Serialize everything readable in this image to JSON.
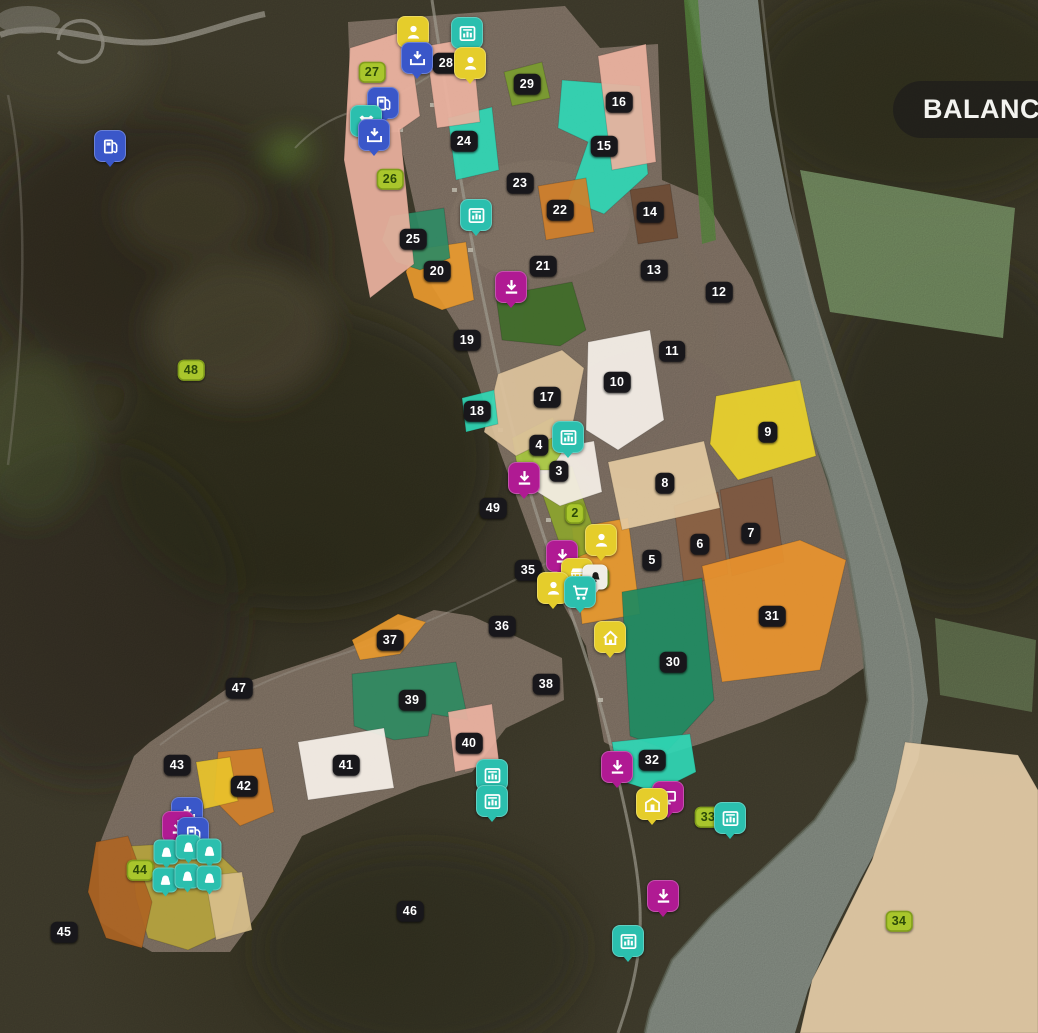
{
  "hud": {
    "balance_label": "BALANCE:"
  },
  "palette": {
    "badge": "#18171b",
    "badge_owned": "#a9c62c",
    "icon_blue": "#3a57c9",
    "icon_yellow": "#e5cd2b",
    "icon_teal": "#2bbfae",
    "icon_magenta": "#b01a93"
  },
  "map": {
    "fields": [
      {
        "num": "1",
        "bx": 600,
        "by": 578,
        "owned": true,
        "fill": "#e8992e",
        "poly": "572,528 628,518 640,614 582,624"
      },
      {
        "num": "2",
        "bx": 575,
        "by": 513,
        "owned": true,
        "fill": "#8ba32e",
        "poly": "536,476 572,466 600,548 566,562"
      },
      {
        "num": "3",
        "bx": 559,
        "by": 471,
        "fill": "#f6f0e8",
        "poly": "534,452 594,441 602,492 560,506 531,488"
      },
      {
        "num": "4",
        "bx": 539,
        "by": 445,
        "fill": "#a5c63e",
        "poly": "512,438 553,417 562,452 550,470 518,470"
      },
      {
        "num": "5",
        "bx": 652,
        "by": 560
      },
      {
        "num": "6",
        "bx": 700,
        "by": 544,
        "fill": "#8a5f42",
        "poly": "674,506 718,492 728,574 684,586"
      },
      {
        "num": "7",
        "bx": 751,
        "by": 533,
        "fill": "#7d5740",
        "poly": "720,490 772,477 784,562 732,576"
      },
      {
        "num": "8",
        "bx": 665,
        "by": 483,
        "fill": "#e3caa2",
        "poly": "608,462 704,441 720,508 622,530"
      },
      {
        "num": "9",
        "bx": 768,
        "by": 432,
        "fill": "#ead32b",
        "poly": "716,396 800,380 816,456 738,480 710,444"
      },
      {
        "num": "10",
        "bx": 617,
        "by": 382,
        "fill": "#f6f1ea",
        "poly": "588,342 650,330 664,420 618,450 586,430"
      },
      {
        "num": "11",
        "bx": 672,
        "by": 351
      },
      {
        "num": "12",
        "bx": 719,
        "by": 292
      },
      {
        "num": "13",
        "bx": 654,
        "by": 270
      },
      {
        "num": "14",
        "bx": 650,
        "by": 212,
        "fill": "#6b4a33",
        "poly": "630,190 670,184 678,238 638,244"
      },
      {
        "num": "15",
        "bx": 604,
        "by": 146,
        "fill": "#2fd7b5",
        "poly": "562,80 640,86 648,174 604,214 568,200 588,142 558,128"
      },
      {
        "num": "16",
        "bx": 619,
        "by": 102,
        "fill": "#ecb2a0",
        "poly": "598,56 646,44 656,162 612,170"
      },
      {
        "num": "17",
        "bx": 547,
        "by": 397,
        "fill": "#dcc29c",
        "poly": "498,374 562,350 584,368 572,428 516,456 484,432"
      },
      {
        "num": "18",
        "bx": 477,
        "by": 411,
        "fill": "#2fd7b5",
        "poly": "462,398 494,390 498,424 466,432"
      },
      {
        "num": "19",
        "bx": 467,
        "by": 340
      },
      {
        "num": "20",
        "bx": 437,
        "by": 271,
        "fill": "#e8992e",
        "poly": "412,250 466,242 474,300 442,310 414,298 406,272"
      },
      {
        "num": "21",
        "bx": 543,
        "by": 266,
        "fill": "#3e6b28",
        "poly": "496,296 572,282 586,330 560,346 502,340"
      },
      {
        "num": "22",
        "bx": 560,
        "by": 210,
        "fill": "#d07f2a",
        "poly": "538,186 586,178 594,232 546,240"
      },
      {
        "num": "23",
        "bx": 520,
        "by": 183
      },
      {
        "num": "24",
        "bx": 464,
        "by": 141,
        "fill": "#2fd7b5",
        "poly": "448,118 492,107 499,170 456,180"
      },
      {
        "num": "25",
        "bx": 413,
        "by": 239,
        "fill": "#2e8a64",
        "poly": "390,216 444,208 450,258 420,270 396,262 382,240"
      },
      {
        "num": "26",
        "bx": 390,
        "by": 179,
        "owned": true
      },
      {
        "num": "27",
        "bx": 372,
        "by": 72,
        "owned": true,
        "fill": "#ecb2a0",
        "poly": "350,48 408,30 420,116 400,130 414,264 370,298 344,160"
      },
      {
        "num": "28",
        "bx": 446,
        "by": 63,
        "fill": "#ecb2a0",
        "poly": "426,46 472,38 480,122 437,128"
      },
      {
        "num": "29",
        "bx": 527,
        "by": 84,
        "fill": "#7a9c2e",
        "poly": "504,72 542,62 550,98 512,106"
      },
      {
        "num": "30",
        "bx": 673,
        "by": 662,
        "fill": "#1d8a61",
        "poly": "622,592 702,578 714,700 668,750 630,736"
      },
      {
        "num": "31",
        "bx": 772,
        "by": 616,
        "fill": "#e8922e",
        "poly": "702,566 800,540 846,560 820,670 722,682"
      },
      {
        "num": "32",
        "bx": 652,
        "by": 760,
        "fill": "#2fd7b5",
        "poly": "612,742 690,734 696,772 656,792 618,780"
      },
      {
        "num": "33",
        "bx": 708,
        "by": 817,
        "owned": true
      },
      {
        "num": "34",
        "bx": 899,
        "by": 921,
        "owned": true,
        "fill": "#e5cda8",
        "poly": "905,742 1018,755 1038,790 1038,1033 800,1033 812,980 840,925 872,860 895,790"
      },
      {
        "num": "35",
        "bx": 528,
        "by": 570
      },
      {
        "num": "36",
        "bx": 502,
        "by": 626
      },
      {
        "num": "37",
        "bx": 390,
        "by": 640,
        "fill": "#e8992e",
        "poly": "352,640 398,614 426,622 400,654 360,660"
      },
      {
        "num": "38",
        "bx": 546,
        "by": 684
      },
      {
        "num": "39",
        "bx": 412,
        "by": 700,
        "fill": "#2e8a62",
        "poly": "352,674 456,662 468,720 432,714 428,736 394,740 354,726"
      },
      {
        "num": "40",
        "bx": 469,
        "by": 743,
        "fill": "#ecb2a2",
        "poly": "448,712 492,704 499,762 455,772"
      },
      {
        "num": "41",
        "bx": 346,
        "by": 765,
        "fill": "#f7f1ea",
        "poly": "298,742 384,728 394,788 308,800"
      },
      {
        "num": "42",
        "bx": 244,
        "by": 786,
        "fill": "#d07f2a",
        "poly": "218,752 262,748 274,812 240,826 214,800"
      },
      {
        "num": "43",
        "bx": 177,
        "by": 765
      },
      {
        "num": "44",
        "bx": 140,
        "by": 870,
        "owned": true,
        "fill": "#b4a23d",
        "poly": "130,846 206,842 244,878 232,930 188,950 148,938 136,898"
      },
      {
        "num": "45",
        "bx": 64,
        "by": 932
      },
      {
        "num": "46",
        "bx": 410,
        "by": 911
      },
      {
        "num": "47",
        "bx": 239,
        "by": 688
      },
      {
        "num": "48",
        "bx": 191,
        "by": 370,
        "owned": true
      },
      {
        "num": "49",
        "bx": 493,
        "by": 508
      }
    ],
    "extra_areas": [
      {
        "fill": "#e9c32b",
        "poly": "196,762 230,757 238,801 204,809"
      },
      {
        "fill": "#ad6423",
        "poly": "96,842 128,836 152,902 142,948 106,938 88,892"
      },
      {
        "fill": "#d8bf8c",
        "poly": "205,876 242,872 252,930 216,940"
      }
    ],
    "icons": [
      {
        "type": "fuel",
        "name": "gas-station",
        "x": 110,
        "y": 146,
        "bg": "#3a57c9"
      },
      {
        "type": "person",
        "name": "contracts-person",
        "x": 413,
        "y": 32,
        "bg": "#e5cd2b"
      },
      {
        "type": "tray",
        "name": "delivery-point",
        "x": 417,
        "y": 58,
        "bg": "#3a57c9"
      },
      {
        "type": "production",
        "name": "production-point",
        "x": 467,
        "y": 33,
        "bg": "#2bbfae"
      },
      {
        "type": "person",
        "name": "contracts-person",
        "x": 470,
        "y": 63,
        "bg": "#e5cd2b"
      },
      {
        "type": "fuel",
        "name": "gas-station",
        "x": 383,
        "y": 103,
        "bg": "#3a57c9"
      },
      {
        "type": "cow",
        "name": "livestock-dealer",
        "x": 366,
        "y": 121,
        "bg": "#2bbfae"
      },
      {
        "type": "tray",
        "name": "delivery-point",
        "x": 374,
        "y": 135,
        "bg": "#3a57c9"
      },
      {
        "type": "production",
        "name": "production-point",
        "x": 476,
        "y": 215,
        "bg": "#2bbfae"
      },
      {
        "type": "sell",
        "name": "sell-point",
        "x": 511,
        "y": 287,
        "bg": "#b01a93"
      },
      {
        "type": "production",
        "name": "production-point",
        "x": 568,
        "y": 437,
        "bg": "#2bbfae"
      },
      {
        "type": "sell",
        "name": "sell-point",
        "x": 524,
        "y": 478,
        "bg": "#b01a93"
      },
      {
        "type": "person",
        "name": "contracts-person",
        "x": 601,
        "y": 540,
        "bg": "#e5cd2b"
      },
      {
        "type": "sell",
        "name": "sell-point",
        "x": 562,
        "y": 556,
        "bg": "#b01a93"
      },
      {
        "type": "basket",
        "name": "supermarket",
        "x": 577,
        "y": 574,
        "bg": "#e5cd2b"
      },
      {
        "type": "bell",
        "name": "bell",
        "x": 595,
        "y": 577,
        "bg": "#f0eee6",
        "fg": "#1d1c18",
        "small": true
      },
      {
        "type": "person",
        "name": "contracts-person",
        "x": 553,
        "y": 588,
        "bg": "#e5cd2b"
      },
      {
        "type": "cart",
        "name": "shop",
        "x": 580,
        "y": 592,
        "bg": "#2bbfae"
      },
      {
        "type": "home",
        "name": "farmhouse",
        "x": 610,
        "y": 637,
        "bg": "#e5cd2b"
      },
      {
        "type": "production",
        "name": "production-point",
        "x": 492,
        "y": 775,
        "bg": "#2bbfae"
      },
      {
        "type": "production",
        "name": "production-point",
        "x": 492,
        "y": 801,
        "bg": "#2bbfae"
      },
      {
        "type": "sell",
        "name": "sell-point",
        "x": 617,
        "y": 767,
        "bg": "#b01a93"
      },
      {
        "type": "monitor",
        "name": "sell-terminal",
        "x": 668,
        "y": 797,
        "bg": "#b01a93"
      },
      {
        "type": "store",
        "name": "market-building",
        "x": 652,
        "y": 804,
        "bg": "#e5cd2b"
      },
      {
        "type": "production",
        "name": "production-point",
        "x": 730,
        "y": 818,
        "bg": "#2bbfae"
      },
      {
        "type": "sell",
        "name": "sell-point",
        "x": 663,
        "y": 896,
        "bg": "#b01a93"
      },
      {
        "type": "production",
        "name": "production-point",
        "x": 628,
        "y": 941,
        "bg": "#2bbfae"
      },
      {
        "type": "tray",
        "name": "delivery-point",
        "x": 187,
        "y": 813,
        "bg": "#3a57c9"
      },
      {
        "type": "sell",
        "name": "sell-point",
        "x": 178,
        "y": 827,
        "bg": "#b01a93"
      },
      {
        "type": "fuel",
        "name": "gas-station",
        "x": 193,
        "y": 833,
        "bg": "#3a57c9"
      },
      {
        "type": "chicken",
        "name": "chicken-pen",
        "x": 166,
        "y": 852,
        "bg": "#2bbfae",
        "small": true
      },
      {
        "type": "chicken",
        "name": "chicken-pen",
        "x": 188,
        "y": 847,
        "bg": "#2bbfae",
        "small": true
      },
      {
        "type": "chicken",
        "name": "chicken-pen",
        "x": 209,
        "y": 851,
        "bg": "#2bbfae",
        "small": true
      },
      {
        "type": "chicken",
        "name": "chicken-pen",
        "x": 165,
        "y": 880,
        "bg": "#2bbfae",
        "small": true
      },
      {
        "type": "chicken",
        "name": "chicken-pen",
        "x": 187,
        "y": 876,
        "bg": "#2bbfae",
        "small": true
      },
      {
        "type": "chicken",
        "name": "chicken-pen",
        "x": 209,
        "y": 878,
        "bg": "#2bbfae",
        "small": true
      }
    ]
  }
}
